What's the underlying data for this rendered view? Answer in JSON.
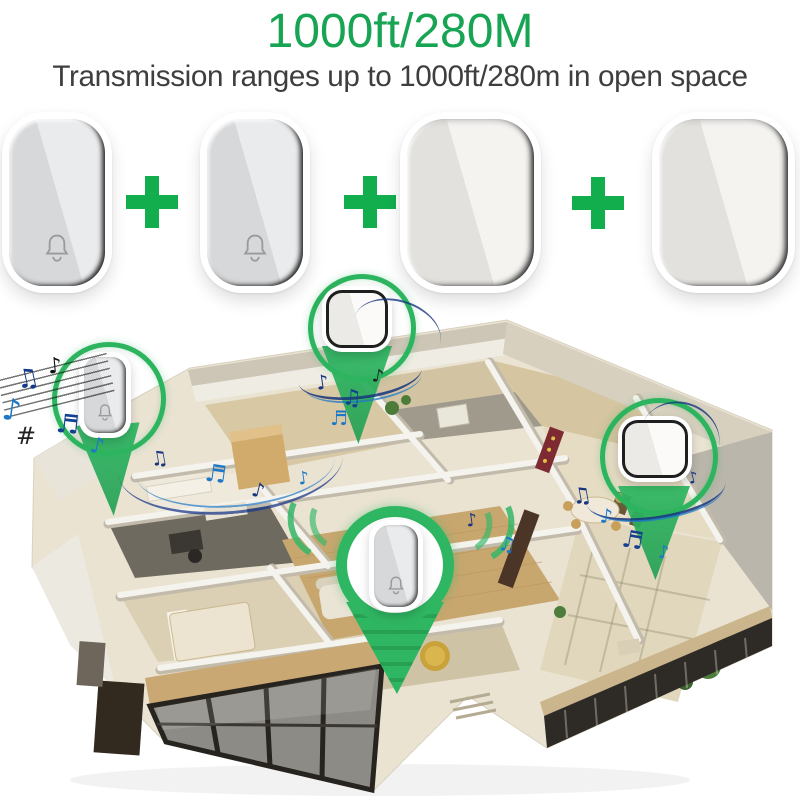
{
  "header": {
    "title": "1000ft/280M",
    "subtitle": "Transmission ranges up to 1000ft/280m in open space"
  },
  "palette": {
    "title_green": "#17a453",
    "plus_green": "#12ae4e",
    "marker_green": "#2db561",
    "note_navy": "#16357e",
    "note_blue": "#1e78c8"
  },
  "kit": {
    "devices": [
      {
        "kind": "wireless doorbell button",
        "icon": "bell-icon"
      },
      {
        "kind": "wireless doorbell button",
        "icon": "bell-icon"
      },
      {
        "kind": "plug-in chime receiver",
        "icon": "none"
      },
      {
        "kind": "plug-in chime receiver",
        "icon": "none"
      }
    ]
  },
  "notes": {
    "eighth": "♪",
    "beamed_eighth": "♫",
    "beamed_sixteenth": "♬",
    "sharp": "#"
  },
  "scene": {
    "type": "isometric cutaway apartment floor plan",
    "markers": [
      "doorbell-button-left",
      "chime-receiver-top",
      "doorbell-button-center",
      "chime-receiver-right"
    ]
  }
}
